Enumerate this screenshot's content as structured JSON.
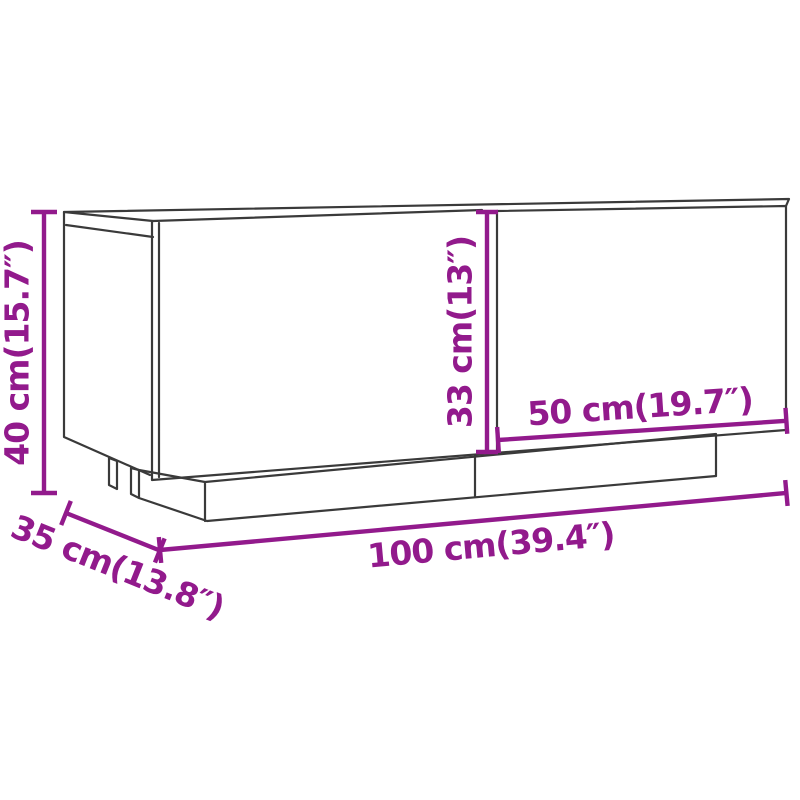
{
  "figure": {
    "kind": "product-dimension-diagram",
    "background_color": "#ffffff",
    "outline_color": "#3a3a3a",
    "dimension_color": "#921A8C",
    "dimensions": {
      "overall_height": {
        "label": "40 cm(15.7″)",
        "cm": 40,
        "inches": 15.7
      },
      "compartment_height": {
        "label": "33 cm(13″)",
        "cm": 33,
        "inches": 13
      },
      "door_width": {
        "label": "50 cm(19.7″)",
        "cm": 50,
        "inches": 19.7
      },
      "overall_width": {
        "label": "100 cm(39.4″)",
        "cm": 100,
        "inches": 39.4
      },
      "depth": {
        "label": "35 cm(13.8″)",
        "cm": 35,
        "inches": 13.8
      }
    }
  }
}
